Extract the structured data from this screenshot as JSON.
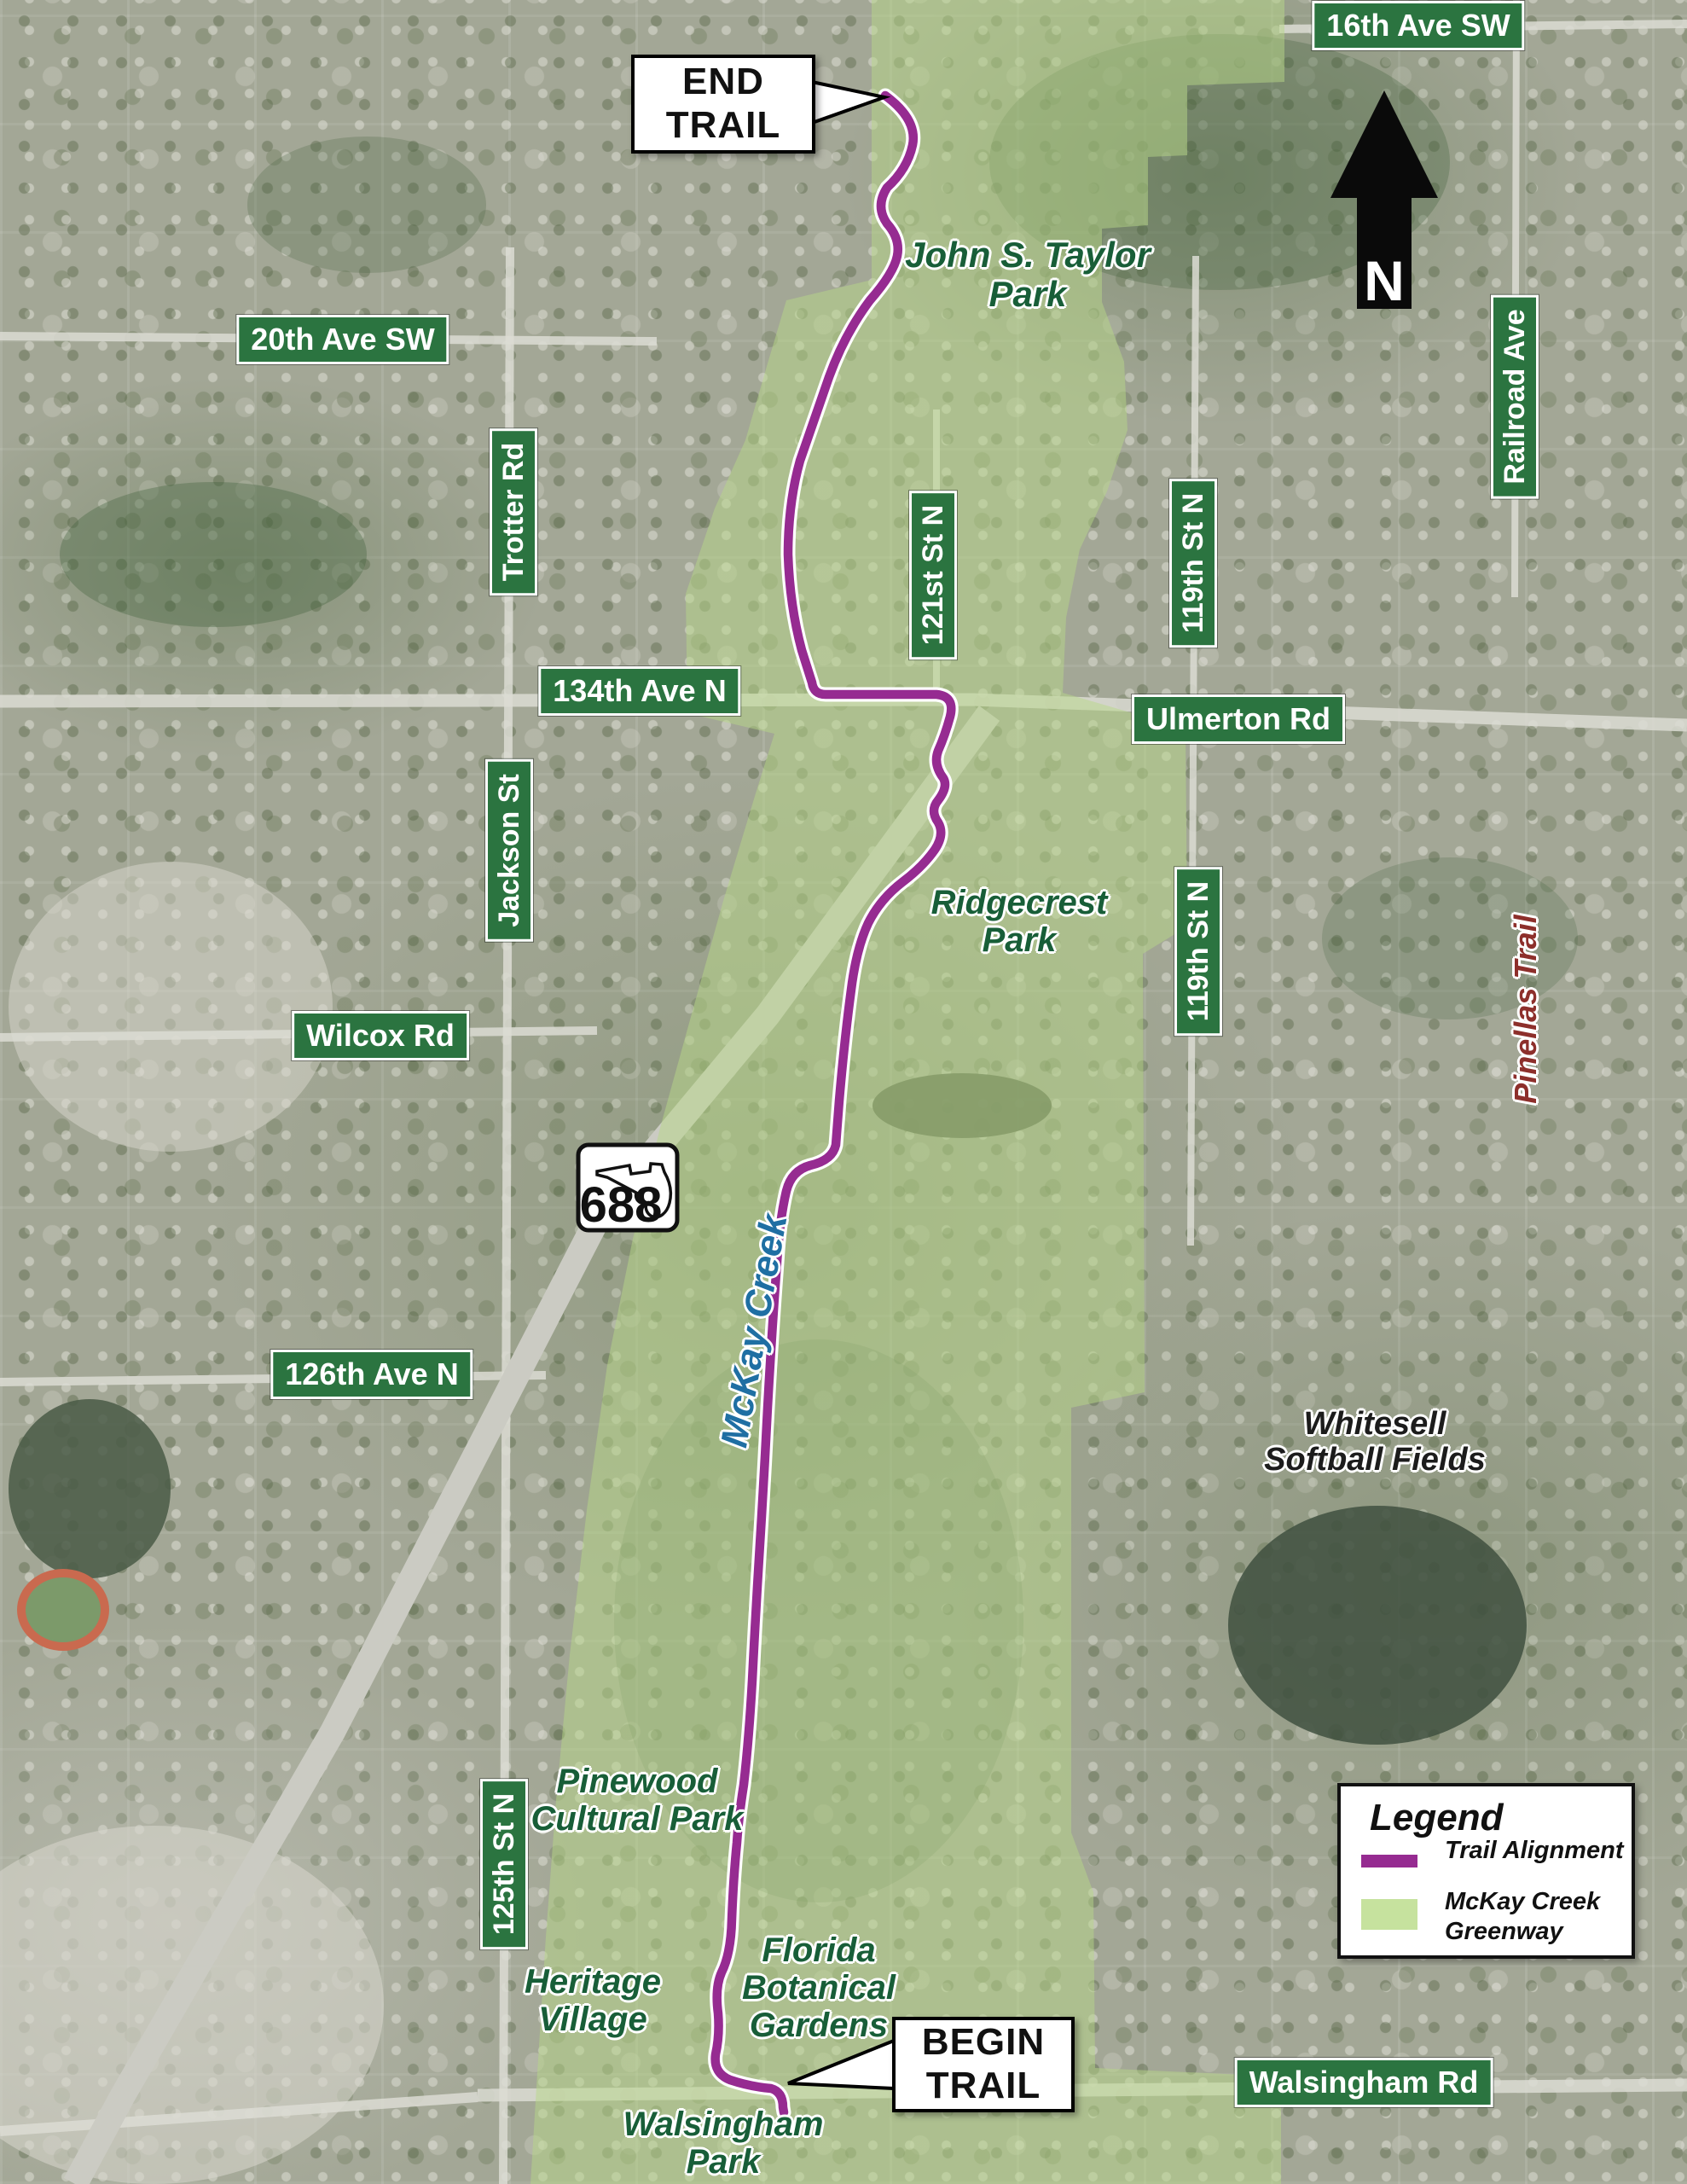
{
  "colors": {
    "badge_green": "#2b7440",
    "park_label_green": "#185e38",
    "facility_label_black": "#1c1c1c",
    "creek_label_blue": "#1f6fa3",
    "pinellas_trail_maroon": "#8d2f2b",
    "trail_purple": "#962b91",
    "greenway_green": "#c6e29e"
  },
  "road_badges": [
    {
      "label": "16th Ave SW"
    },
    {
      "label": "20th Ave SW"
    },
    {
      "label": "Trotter Rd"
    },
    {
      "label": "134th Ave N"
    },
    {
      "label": "121st St N"
    },
    {
      "label": "119th St N"
    },
    {
      "label": "Railroad Ave"
    },
    {
      "label": "Ulmerton Rd"
    },
    {
      "label": "Jackson St"
    },
    {
      "label": "119th St N"
    },
    {
      "label": "Wilcox Rd"
    },
    {
      "label": "126th Ave N"
    },
    {
      "label": "125th St N"
    },
    {
      "label": "Walsingham Rd"
    }
  ],
  "place_labels": [
    {
      "name": "John S. Taylor Park",
      "lines": [
        "John S. Taylor",
        "Park"
      ]
    },
    {
      "name": "Ridgecrest Park",
      "lines": [
        "Ridgecrest",
        "Park"
      ]
    },
    {
      "name": "Whitesell Softball Fields",
      "lines": [
        "Whitesell",
        "Softball Fields"
      ]
    },
    {
      "name": "Pinewood Cultural Park",
      "lines": [
        "Pinewood",
        "Cultural Park"
      ]
    },
    {
      "name": "Heritage Village",
      "lines": [
        "Heritage",
        "Village"
      ]
    },
    {
      "name": "Florida Botanical Gardens",
      "lines": [
        "Florida",
        "Botanical",
        "Gardens"
      ]
    },
    {
      "name": "Walsingham Park",
      "lines": [
        "Walsingham",
        "Park"
      ]
    },
    {
      "name": "McKay Creek",
      "lines": [
        "McKay Creek"
      ]
    },
    {
      "name": "Pinellas Trail",
      "lines": [
        "Pinellas Trail"
      ]
    }
  ],
  "callouts": {
    "end": {
      "lines": [
        "END",
        "TRAIL"
      ]
    },
    "begin": {
      "lines": [
        "BEGIN",
        "TRAIL"
      ]
    }
  },
  "north_arrow": {
    "label": "N"
  },
  "route_shield": {
    "number": "688"
  },
  "legend": {
    "title": "Legend",
    "items": [
      {
        "label_lines": [
          "Trail Alignment"
        ],
        "swatch": "line",
        "color": "#962b91"
      },
      {
        "label_lines": [
          "McKay Creek",
          "Greenway"
        ],
        "swatch": "area",
        "color": "#c6e29e"
      }
    ]
  }
}
